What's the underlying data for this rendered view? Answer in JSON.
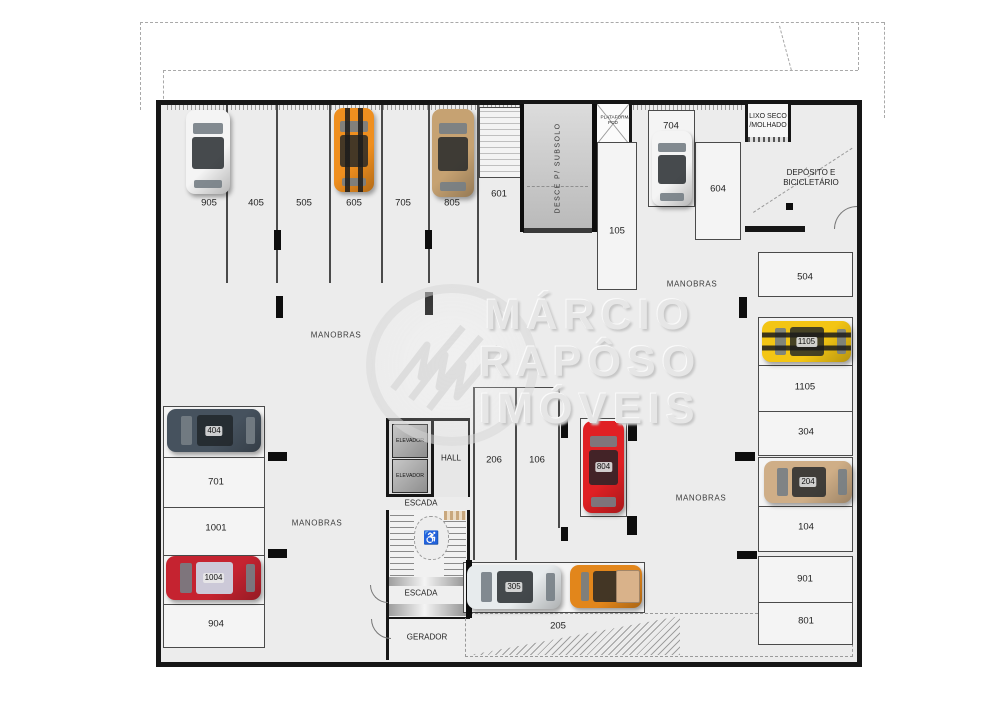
{
  "watermark": {
    "lines": [
      "MÁRCIO",
      "RAPÔSO",
      "IMÓVEIS"
    ]
  },
  "plan": {
    "ramp_label": "DESCE P/ SUBSOLO",
    "pcd": [
      "PLATAFORMA",
      "PCD"
    ],
    "lixo": [
      "LIXO SECO",
      "/MOLHADO"
    ],
    "deposito": [
      "DEPÓSITO E",
      "BICICLETÁRIO"
    ],
    "elevator_label": "ELEVADOR",
    "floor_labels": [
      {
        "t": "905",
        "x": 209,
        "y": 203
      },
      {
        "t": "405",
        "x": 256,
        "y": 203
      },
      {
        "t": "505",
        "x": 304,
        "y": 203
      },
      {
        "t": "605",
        "x": 354,
        "y": 203
      },
      {
        "t": "705",
        "x": 403,
        "y": 203
      },
      {
        "t": "805",
        "x": 452,
        "y": 203
      },
      {
        "t": "601",
        "x": 499,
        "y": 194
      },
      {
        "t": "704",
        "x": 671,
        "y": 126
      },
      {
        "t": "105",
        "x": 617,
        "y": 231
      },
      {
        "t": "604",
        "x": 718,
        "y": 189
      },
      {
        "t": "504",
        "x": 805,
        "y": 277
      },
      {
        "t": "1105",
        "x": 805,
        "y": 387
      },
      {
        "t": "304",
        "x": 806,
        "y": 432
      },
      {
        "t": "104",
        "x": 806,
        "y": 527
      },
      {
        "t": "901",
        "x": 805,
        "y": 579
      },
      {
        "t": "801",
        "x": 806,
        "y": 621
      },
      {
        "t": "701",
        "x": 216,
        "y": 482
      },
      {
        "t": "1001",
        "x": 216,
        "y": 528
      },
      {
        "t": "904",
        "x": 216,
        "y": 624
      },
      {
        "t": "206",
        "x": 494,
        "y": 460
      },
      {
        "t": "106",
        "x": 537,
        "y": 460
      },
      {
        "t": "205",
        "x": 558,
        "y": 626
      },
      {
        "t": "HALL",
        "x": 451,
        "y": 458,
        "cls": "tiny"
      },
      {
        "t": "ESCADA",
        "x": 421,
        "y": 503,
        "cls": "tiny"
      },
      {
        "t": "ESCADA",
        "x": 421,
        "y": 593,
        "cls": "tiny"
      },
      {
        "t": "GERADOR",
        "x": 427,
        "y": 637,
        "cls": "tiny"
      },
      {
        "t": "MANOBRAS",
        "x": 336,
        "y": 335,
        "cls": "manobras"
      },
      {
        "t": "MANOBRAS",
        "x": 692,
        "y": 284,
        "cls": "manobras"
      },
      {
        "t": "MANOBRAS",
        "x": 317,
        "y": 523,
        "cls": "manobras"
      },
      {
        "t": "MANOBRAS",
        "x": 701,
        "y": 498,
        "cls": "manobras"
      }
    ],
    "spot_boxes": [
      {
        "name": "spots-left-group",
        "x": 163,
        "y": 406,
        "w": 102,
        "h": 242,
        "div": [
          456,
          506,
          554,
          603
        ]
      },
      {
        "name": "spot-504",
        "x": 758,
        "y": 252,
        "w": 95,
        "h": 45
      },
      {
        "name": "spots-right-group-a",
        "x": 758,
        "y": 317,
        "w": 95,
        "h": 139,
        "div": [
          364,
          410
        ]
      },
      {
        "name": "spots-right-group-b",
        "x": 758,
        "y": 457,
        "w": 95,
        "h": 95,
        "div": [
          505
        ]
      },
      {
        "name": "spots-right-group-c",
        "x": 758,
        "y": 556,
        "w": 95,
        "h": 89,
        "div": [
          601
        ]
      },
      {
        "name": "spot-105",
        "x": 597,
        "y": 142,
        "w": 40,
        "h": 148
      },
      {
        "name": "spot-704",
        "x": 648,
        "y": 110,
        "w": 47,
        "h": 97
      },
      {
        "name": "spot-604",
        "x": 695,
        "y": 142,
        "w": 46,
        "h": 98
      },
      {
        "name": "spot-804",
        "x": 580,
        "y": 418,
        "w": 47,
        "h": 99
      },
      {
        "name": "spot-305-205",
        "x": 463,
        "y": 562,
        "w": 182,
        "h": 51
      },
      {
        "name": "storage-601",
        "x": 479,
        "y": 107,
        "w": 42,
        "h": 71,
        "cls": "hatch"
      }
    ],
    "vlines": [
      {
        "x": 226,
        "y": 105,
        "h": 178
      },
      {
        "x": 276,
        "y": 105,
        "h": 178
      },
      {
        "x": 329,
        "y": 105,
        "h": 178
      },
      {
        "x": 381,
        "y": 105,
        "h": 178
      },
      {
        "x": 428,
        "y": 105,
        "h": 178
      },
      {
        "x": 477,
        "y": 105,
        "h": 178
      },
      {
        "x": 473,
        "y": 387,
        "h": 173
      },
      {
        "x": 515,
        "y": 387,
        "h": 173
      },
      {
        "x": 558,
        "y": 387,
        "h": 141
      }
    ],
    "hlines": [
      {
        "x": 473,
        "y": 387,
        "w": 86
      }
    ],
    "columns": [
      {
        "x": 274,
        "y": 230,
        "w": 7,
        "h": 20
      },
      {
        "x": 425,
        "y": 230,
        "w": 7,
        "h": 19
      },
      {
        "x": 276,
        "y": 296,
        "w": 7,
        "h": 22
      },
      {
        "x": 425,
        "y": 292,
        "w": 8,
        "h": 23
      },
      {
        "x": 268,
        "y": 452,
        "w": 19,
        "h": 9
      },
      {
        "x": 268,
        "y": 549,
        "w": 19,
        "h": 9
      },
      {
        "x": 739,
        "y": 297,
        "w": 8,
        "h": 21
      },
      {
        "x": 735,
        "y": 452,
        "w": 20,
        "h": 9
      },
      {
        "x": 737,
        "y": 551,
        "w": 20,
        "h": 8
      },
      {
        "x": 561,
        "y": 417,
        "w": 7,
        "h": 21
      },
      {
        "x": 561,
        "y": 527,
        "w": 7,
        "h": 14
      },
      {
        "x": 628,
        "y": 422,
        "w": 9,
        "h": 19
      },
      {
        "x": 627,
        "y": 516,
        "w": 10,
        "h": 19
      },
      {
        "x": 786,
        "y": 203,
        "w": 7,
        "h": 7
      },
      {
        "x": 466,
        "y": 560,
        "w": 6,
        "h": 58
      },
      {
        "x": 520,
        "y": 104,
        "w": 4,
        "h": 128
      },
      {
        "x": 592,
        "y": 104,
        "w": 5,
        "h": 128
      }
    ],
    "cars": [
      {
        "name": "car-905",
        "label": "",
        "x": 186,
        "y": 110,
        "w": 44,
        "h": 84,
        "dir": "v",
        "color": "#f4f4f4"
      },
      {
        "name": "car-605",
        "label": "",
        "x": 334,
        "y": 108,
        "w": 40,
        "h": 84,
        "dir": "v",
        "color": "#ef8f1f",
        "stripes": true
      },
      {
        "name": "car-805",
        "label": "",
        "x": 432,
        "y": 109,
        "w": 42,
        "h": 88,
        "dir": "v",
        "color": "#c6a272"
      },
      {
        "name": "car-704",
        "label": "",
        "x": 652,
        "y": 131,
        "w": 40,
        "h": 75,
        "dir": "v",
        "color": "#f4f4f4"
      },
      {
        "name": "car-804",
        "label": "804",
        "x": 583,
        "y": 421,
        "w": 41,
        "h": 92,
        "dir": "v",
        "color": "#e02024"
      },
      {
        "name": "car-404",
        "label": "404",
        "x": 167,
        "y": 409,
        "w": 94,
        "h": 43,
        "dir": "h",
        "color": "#46525e"
      },
      {
        "name": "car-1004",
        "label": "1004",
        "x": 166,
        "y": 556,
        "w": 95,
        "h": 44,
        "dir": "h",
        "color": "#c52330",
        "roof": "#ccc9d8"
      },
      {
        "name": "car-1105",
        "label": "1105",
        "x": 762,
        "y": 321,
        "w": 89,
        "h": 41,
        "dir": "h",
        "color": "#f3c514",
        "stripes": true
      },
      {
        "name": "car-204",
        "label": "204",
        "x": 764,
        "y": 461,
        "w": 88,
        "h": 42,
        "dir": "h",
        "color": "#cfae87"
      },
      {
        "name": "car-305",
        "label": "305",
        "x": 467,
        "y": 565,
        "w": 94,
        "h": 44,
        "dir": "h",
        "color": "#e7ebed"
      },
      {
        "name": "car-205",
        "label": "",
        "x": 570,
        "y": 565,
        "w": 72,
        "h": 43,
        "dir": "h",
        "color": "#e2861b",
        "bed": true
      }
    ]
  }
}
